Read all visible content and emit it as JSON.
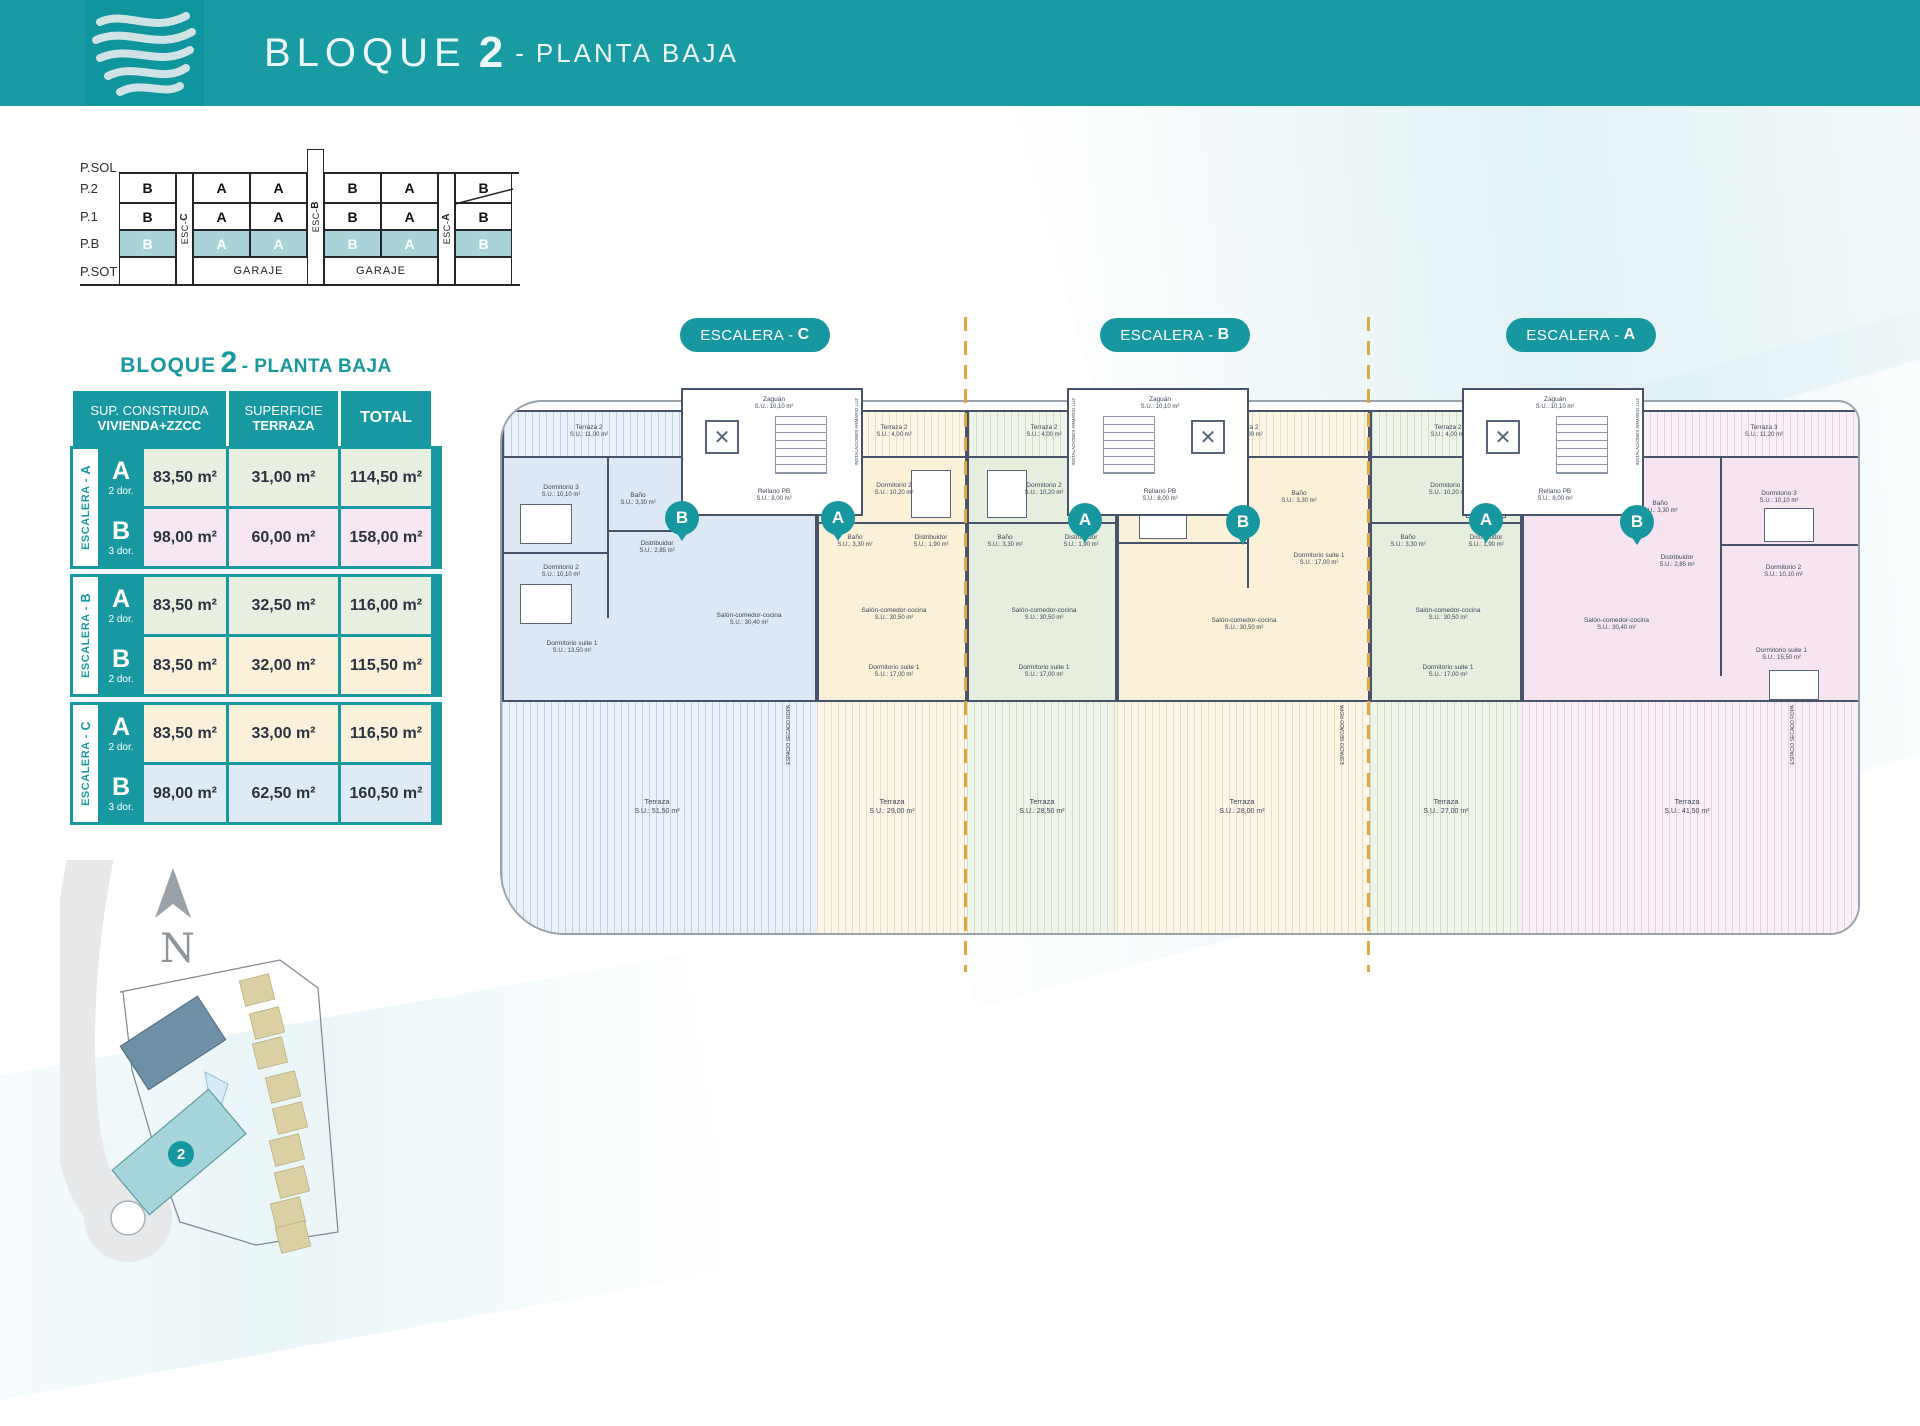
{
  "header": {
    "title": {
      "pre": "BLOQUE",
      "num": "2",
      "dash": "-",
      "sub": "PLANTA BAJA"
    }
  },
  "colors": {
    "teal": "#1899a1",
    "teal_header": "#189ba3",
    "amber_dash": "#dfa83d",
    "wall": "#47536b",
    "unit_blue": "#dce8f4",
    "unit_cream": "#fbf1d9",
    "unit_green": "#e6eedd",
    "unit_pink": "#f6e5f1",
    "pb_highlight": "#a9d3d9"
  },
  "section": {
    "floors": [
      "P.SOL",
      "P.2",
      "P.1",
      "P.B",
      "P.SOT"
    ],
    "esc": [
      {
        "pre": "ESC-",
        "letter": "C"
      },
      {
        "pre": "ESC-",
        "letter": "B"
      },
      {
        "pre": "ESC-",
        "letter": "A"
      }
    ],
    "rows": {
      "p2": [
        "B",
        "A",
        "A",
        "B",
        "A",
        "B"
      ],
      "p1": [
        "B",
        "A",
        "A",
        "B",
        "A",
        "B"
      ],
      "pb": [
        "B",
        "A",
        "A",
        "B",
        "A",
        "B"
      ]
    },
    "garaje": "GARAJE"
  },
  "table": {
    "title": {
      "pre": "BLOQUE",
      "num": "2",
      "post": "- PLANTA BAJA"
    },
    "headers": {
      "h1a": "SUP. CONSTRUIDA",
      "h1b": "VIVIENDA+ZZCC",
      "h2a": "SUPERFICIE",
      "h2b": "TERRAZA",
      "h3": "TOTAL"
    },
    "groups": [
      {
        "label_pre": "ESCALERA - ",
        "letter": "A",
        "rows": [
          {
            "letter": "A",
            "dorms": "2 dor.",
            "construida": "83,50 m²",
            "terraza": "31,00 m²",
            "total": "114,50 m²"
          },
          {
            "letter": "B",
            "dorms": "3 dor.",
            "construida": "98,00 m²",
            "terraza": "60,00 m²",
            "total": "158,00 m²"
          }
        ]
      },
      {
        "label_pre": "ESCALERA - ",
        "letter": "B",
        "rows": [
          {
            "letter": "A",
            "dorms": "2 dor.",
            "construida": "83,50 m²",
            "terraza": "32,50 m²",
            "total": "116,00 m²"
          },
          {
            "letter": "B",
            "dorms": "2 dor.",
            "construida": "83,50 m²",
            "terraza": "32,00 m²",
            "total": "115,50 m²"
          }
        ]
      },
      {
        "label_pre": "ESCALERA - ",
        "letter": "C",
        "rows": [
          {
            "letter": "A",
            "dorms": "2 dor.",
            "construida": "83,50 m²",
            "terraza": "33,00 m²",
            "total": "116,50 m²"
          },
          {
            "letter": "B",
            "dorms": "3 dor.",
            "construida": "98,00 m²",
            "terraza": "62,50 m²",
            "total": "160,50 m²"
          }
        ]
      }
    ]
  },
  "plan": {
    "pills": [
      {
        "pre": "ESCALERA - ",
        "letter": "C"
      },
      {
        "pre": "ESCALERA - ",
        "letter": "B"
      },
      {
        "pre": "ESCALERA - ",
        "letter": "A"
      }
    ],
    "badges": [
      "B",
      "A",
      "A",
      "B",
      "A",
      "B"
    ],
    "core": {
      "zaguan": "Zaguán",
      "zaguan_area": "S.U.: 10,10 m²",
      "rellano": "Rellano PB",
      "rellano_area": "S.U.: 8,00 m²",
      "inst": "INSTALACIONES ARMARIO LUZ"
    },
    "secado": "ESPACIO SECADO ROPA",
    "units": [
      {
        "rooms": {
          "terraza2": {
            "name": "Terraza 2",
            "area": "S.U.: 11,00 m²"
          },
          "dorm3": {
            "name": "Dormitorio 3",
            "area": "S.U.: 10,10 m²"
          },
          "bano": {
            "name": "Baño",
            "area": "S.U.: 3,30 m²"
          },
          "dorm2": {
            "name": "Dormitorio 2",
            "area": "S.U.: 10,10 m²"
          },
          "distribuidor": {
            "name": "Distribuidor",
            "area": "S.U.: 2,85 m²"
          },
          "suite": {
            "name": "Dormitorio suite 1",
            "area": "S.U.: 13,50 m²"
          },
          "salon": {
            "name": "Salón-comedor-cocina",
            "area": "S.U.: 30,40 m²"
          }
        },
        "terrace": {
          "name": "Terraza",
          "area": "S.U.: 51,50 m²"
        }
      },
      {
        "rooms": {
          "terraza2": {
            "name": "Terraza 2",
            "area": "S.U.: 4,00 m²"
          },
          "dorm2": {
            "name": "Dormitorio 2",
            "area": "S.U.: 10,20 m²"
          },
          "bano": {
            "name": "Baño",
            "area": "S.U.: 3,30 m²"
          },
          "distribuidor": {
            "name": "Distribuidor",
            "area": "S.U.: 1,90 m²"
          },
          "trastero": {
            "name": "Trastero",
            "area": "S.U.: 1,40 m²"
          },
          "suite": {
            "name": "Dormitorio suite 1",
            "area": "S.U.: 17,00 m²"
          },
          "salon": {
            "name": "Salón-comedor-cocina",
            "area": "S.U.: 30,50 m²"
          }
        },
        "terrace": {
          "name": "Terraza",
          "area": "S.U.: 29,00 m²"
        }
      },
      {
        "rooms": {
          "terraza2": {
            "name": "Terraza 2",
            "area": "S.U.: 4,00 m²"
          },
          "dorm2": {
            "name": "Dormitorio 2",
            "area": "S.U.: 10,20 m²"
          },
          "bano": {
            "name": "Baño",
            "area": "S.U.: 3,30 m²"
          },
          "distribuidor": {
            "name": "Distribuidor",
            "area": "S.U.: 1,90 m²"
          },
          "trastero": {
            "name": "Trastero",
            "area": "S.U.: 1,40 m²"
          },
          "suite": {
            "name": "Dormitorio suite 1",
            "area": "S.U.: 17,00 m²"
          },
          "salon": {
            "name": "Salón-comedor-cocina",
            "area": "S.U.: 30,50 m²"
          }
        },
        "terrace": {
          "name": "Terraza",
          "area": "S.U.: 28,50 m²"
        }
      },
      {
        "rooms": {
          "terraza2": {
            "name": "Terraza 2",
            "area": "S.U.: 4,00 m²"
          },
          "dorm2": {
            "name": "Dormitorio 2",
            "area": "S.U.: 10,20 m²"
          },
          "bano": {
            "name": "Baño",
            "area": "S.U.: 3,30 m²"
          },
          "distribuidor": {
            "name": "Distribuidor",
            "area": "S.U.: 1,90 m²"
          },
          "trastero": {
            "name": "Trastero",
            "area": "S.U.: 1,45 m²"
          },
          "suite": {
            "name": "Dormitorio suite 1",
            "area": "S.U.: 17,00 m²"
          },
          "salon": {
            "name": "Salón-comedor-cocina",
            "area": "S.U.: 30,50 m²"
          }
        },
        "terrace": {
          "name": "Terraza",
          "area": "S.U.: 28,00 m²"
        }
      },
      {
        "rooms": {
          "terraza2": {
            "name": "Terraza 2",
            "area": "S.U.: 4,00 m²"
          },
          "dorm2": {
            "name": "Dormitorio 2",
            "area": "S.U.: 10,20 m²"
          },
          "bano": {
            "name": "Baño",
            "area": "S.U.: 3,30 m²"
          },
          "distribuidor": {
            "name": "Distribuidor",
            "area": "S.U.: 1,90 m²"
          },
          "trastero": {
            "name": "Trastero",
            "area": "S.U.: 1,40 m²"
          },
          "suite": {
            "name": "Dormitorio suite 1",
            "area": "S.U.: 17,00 m²"
          },
          "salon": {
            "name": "Salón-comedor-cocina",
            "area": "S.U.: 30,50 m²"
          }
        },
        "terrace": {
          "name": "Terraza",
          "area": "S.U.: 27,00 m²"
        }
      },
      {
        "rooms": {
          "terraza3": {
            "name": "Terraza 3",
            "area": "S.U.: 11,20 m²"
          },
          "dorm3": {
            "name": "Dormitorio 3",
            "area": "S.U.: 10,10 m²"
          },
          "bano": {
            "name": "Baño",
            "area": "S.U.: 3,30 m²"
          },
          "distribuidor": {
            "name": "Distribuidor",
            "area": "S.U.: 2,85 m²"
          },
          "dorm2": {
            "name": "Dormitorio 2",
            "area": "S.U.: 10,10 m²"
          },
          "suite": {
            "name": "Dormitorio suite 1",
            "area": "S.U.: 15,50 m²"
          },
          "salon": {
            "name": "Salón-comedor-cocina",
            "area": "S.U.: 30,40 m²"
          }
        },
        "terrace": {
          "name": "Terraza",
          "area": "S.U.: 41,50 m²"
        }
      }
    ]
  },
  "site": {
    "north": "N",
    "block_badge": "2"
  }
}
